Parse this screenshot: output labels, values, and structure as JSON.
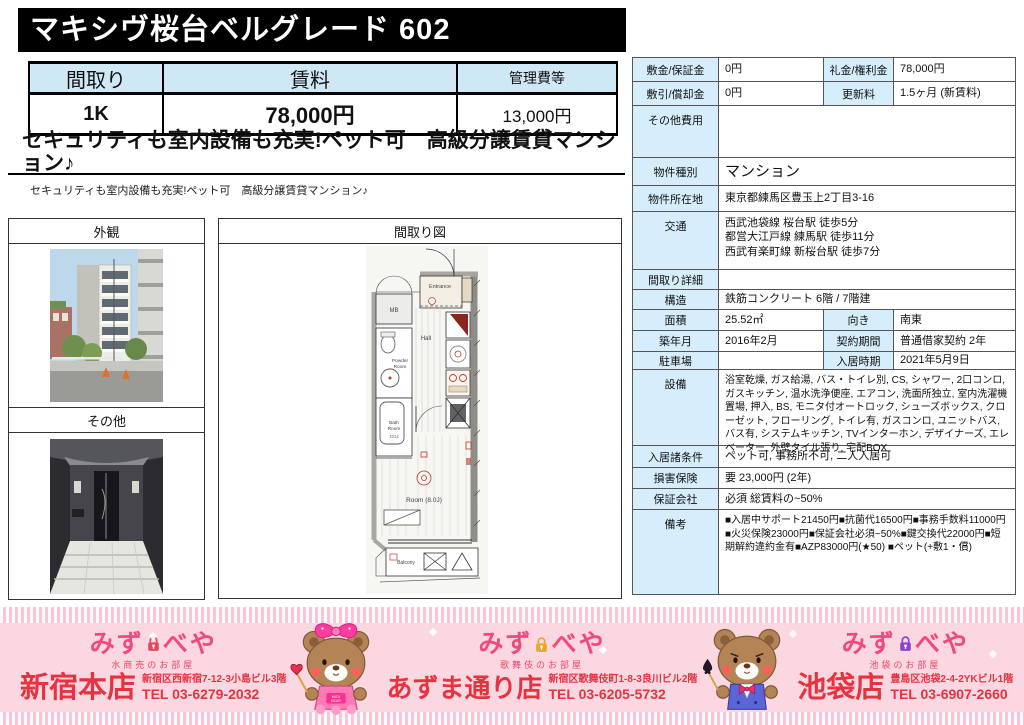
{
  "title": "マキシヴ桜台ベルグレード 602",
  "summary": {
    "headers": [
      "間取り",
      "賃料",
      "管理費等"
    ],
    "values": [
      "1K",
      "78,000円",
      "13,000円"
    ]
  },
  "catch_copy": {
    "large": "セキュリティも室内設備も充実!ペット可　高級分譲賃貸マンション♪",
    "small": "セキュリティも室内設備も充実!ペット可　高級分譲賃貸マンション♪"
  },
  "photos": {
    "exterior_label": "外観",
    "other_label": "その他"
  },
  "floorplan": {
    "label": "間取り図",
    "labels": {
      "mb": "MB",
      "entrance": "Entrance",
      "hall": "Hall",
      "powder_room_1": "Powder",
      "powder_room_2": "Room",
      "bath_room_1": "Bath",
      "bath_room_2": "Room",
      "bath_size": "1014",
      "room": "Room (8.0J)",
      "balcony": "Balcony"
    }
  },
  "details": {
    "rows": [
      {
        "cells": [
          {
            "label": "敷金/保証金",
            "value": "0円"
          },
          {
            "label": "礼金/権利金",
            "value": "78,000円"
          }
        ]
      },
      {
        "cells": [
          {
            "label": "敷引/償却金",
            "value": "0円"
          },
          {
            "label": "更新料",
            "value": "1.5ヶ月 (新賃料)"
          }
        ]
      },
      {
        "label": "その他費用",
        "value": ""
      },
      {
        "label": "物件種別",
        "value": "マンション"
      },
      {
        "label": "物件所在地",
        "value": "東京都練馬区豊玉上2丁目3-16"
      },
      {
        "label": "交通",
        "value": "西武池袋線 桜台駅 徒歩5分\n都営大江戸線 練馬駅 徒歩11分\n西武有楽町線 新桜台駅 徒歩7分"
      },
      {
        "label": "間取り詳細",
        "value": ""
      },
      {
        "label": "構造",
        "value": "鉄筋コンクリート 6階 / 7階建"
      },
      {
        "cells": [
          {
            "label": "面積",
            "value": "25.52㎡"
          },
          {
            "label": "向き",
            "value": "南東"
          }
        ]
      },
      {
        "cells": [
          {
            "label": "築年月",
            "value": "2016年2月"
          },
          {
            "label": "契約期間",
            "value": "普通借家契約 2年"
          }
        ]
      },
      {
        "cells": [
          {
            "label": "駐車場",
            "value": ""
          },
          {
            "label": "入居時期",
            "value": "2021年5月9日"
          }
        ]
      },
      {
        "label": "設備",
        "value": "浴室乾燥, ガス給湯, バス・トイレ別, CS, シャワー, 2口コンロ, ガスキッチン, 温水洗浄便座, エアコン, 洗面所独立, 室内洗濯機置場, 押入, BS, モニタ付オートロック, シューズボックス, クローゼット, フローリング, トイレ有, ガスコンロ, ユニットバス, バス有, システムキッチン, TVインターホン, デザイナーズ, エレベーター, 外壁タイル張り, 宅配BOX"
      },
      {
        "label": "入居諸条件",
        "value": "ペット可, 事務所不可, 二人入居可"
      },
      {
        "label": "損害保険",
        "value": "要 23,000円 (2年)"
      },
      {
        "label": "保証会社",
        "value": "必須 総賃料の~50%"
      },
      {
        "label": "備考",
        "value": "■入居中サポート21450円■抗菌代16500円■事務手数料11000円■火災保険23000円■保証会社必須~50%■鍵交換代22000円■短期解約違約金有■AZP83000円(★50) ■ペット(+敷1・償)"
      }
    ]
  },
  "footer": {
    "stores": [
      {
        "brand_left": "みず",
        "brand_right": "べや",
        "tagline": "水商売のお部屋",
        "name": "新宿本店",
        "address": "新宿区西新宿7-12-3小島ビル3階",
        "tel": "TEL 03-6279-2032",
        "lock_color": "#e2485f"
      },
      {
        "brand_left": "みず",
        "brand_right": "べや",
        "tagline": "歌舞伎のお部屋",
        "name": "あずま通り店",
        "address": "新宿区歌舞伎町1-8-3良川ビル2階",
        "tel": "TEL 03-6205-5732",
        "lock_color": "#e8a62b"
      },
      {
        "brand_left": "みず",
        "brand_right": "べや",
        "tagline": "池袋のお部屋",
        "name": "池袋店",
        "address": "豊島区池袋2-4-2YKビル1階",
        "tel": "TEL 03-6907-2660",
        "lock_color": "#8e44c8"
      }
    ]
  },
  "colors": {
    "table_header_blue": "#cfe8f6",
    "detail_label_blue": "#d6eefb",
    "footer_pink": "#fbd7e2",
    "store_red": "#e5333f",
    "brand_pink": "#f2487a",
    "title_bar_black": "#000000"
  },
  "icons": {
    "lock-icon": "padlock glyph inside みずべや logo",
    "bear-girl-mascot-icon": "brown bear with pink bow holding heart wand",
    "bear-boy-mascot-icon": "brown bear with blue vest holding spade wand",
    "music-note": "♪"
  }
}
